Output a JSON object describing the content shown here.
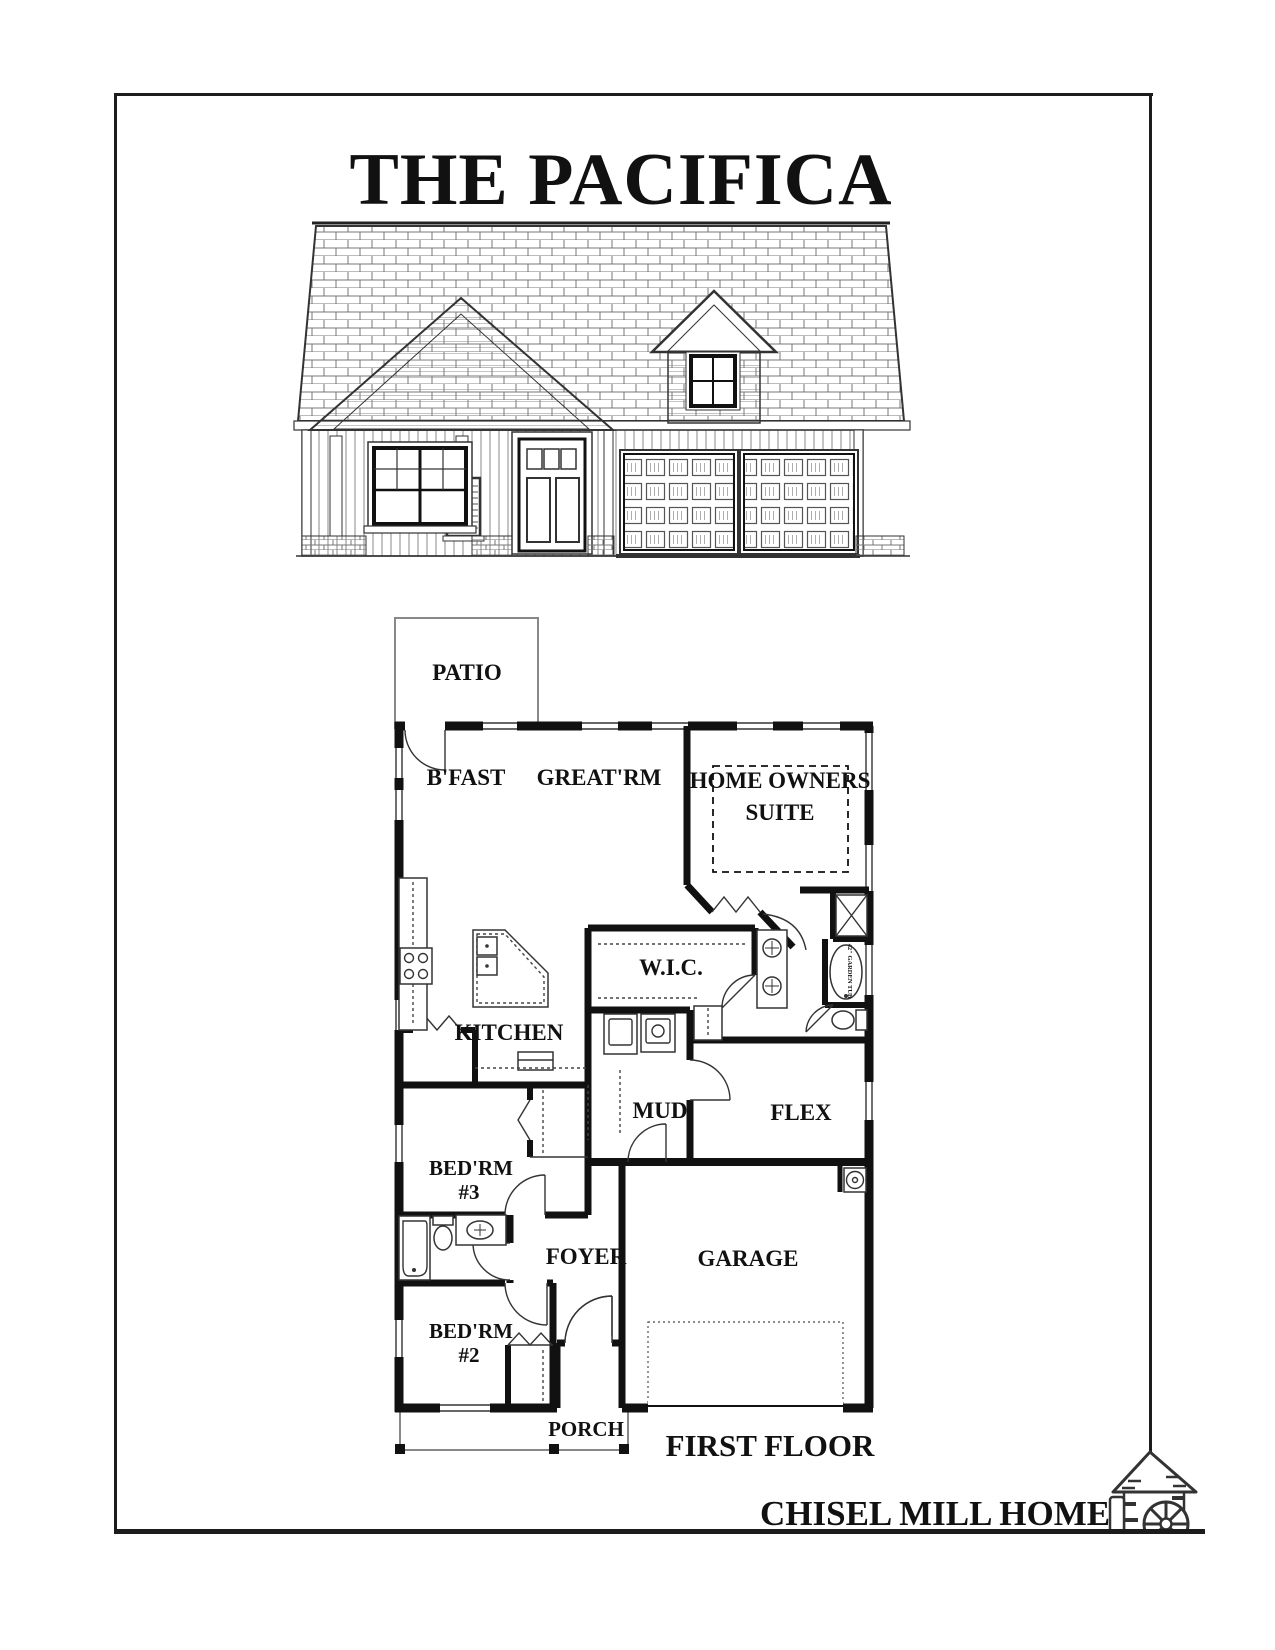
{
  "doc": {
    "title": "THE PACIFICA",
    "floor_label": "FIRST FLOOR",
    "brand": "CHISEL MILL HOMES"
  },
  "plan": {
    "rooms": {
      "patio": "PATIO",
      "bfast": "B'FAST",
      "great_rm": "GREAT'RM",
      "owners_suite_line1": "HOME OWNERS",
      "owners_suite_line2": "SUITE",
      "wic": "W.I.C.",
      "kitchen": "KITCHEN",
      "mud": "MUD",
      "flex": "FLEX",
      "bed3_line1": "BED'RM",
      "bed3_line2": "#3",
      "foyer": "FOYER",
      "garage": "GARAGE",
      "bed2_line1": "BED'RM",
      "bed2_line2": "#2",
      "porch": "PORCH"
    },
    "fixtures": {
      "garden_tub": "42\" GARDEN TUB"
    }
  }
}
